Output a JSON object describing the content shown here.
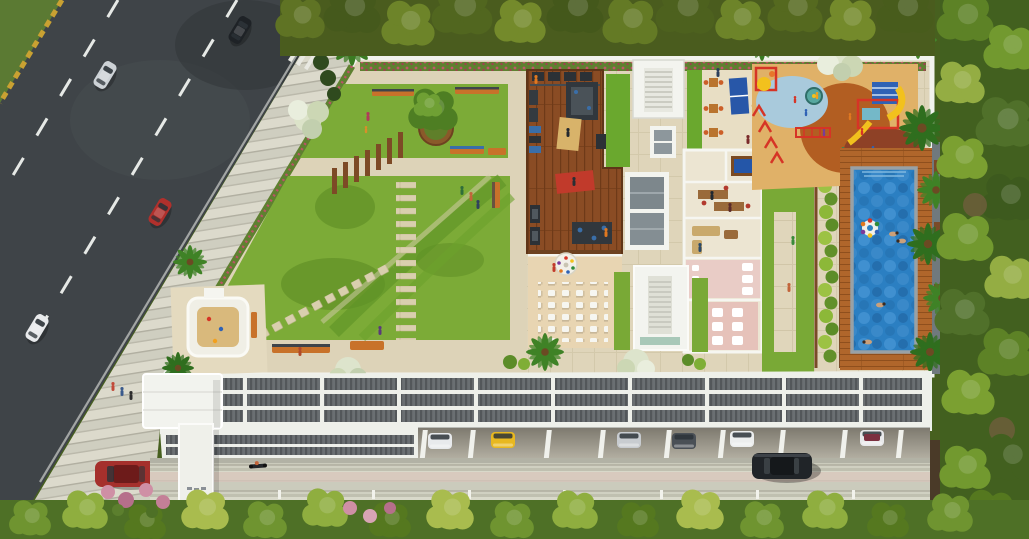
{
  "scene": {
    "title": "Aerial 3D architectural render of a residential podium amenity deck",
    "description": "Top-down rendering: city road with traffic on the left, landscaped rooftop podium with lawn garden, pergola, outdoor gym deck, stair cores with skylights, clubhouse rooms, party patio, kids play area and swimming pool; louvered parking canopy and driveway along the bottom; dense trees framing top, right and bottom edges.",
    "palette": {
      "asphalt": "#3f4448",
      "roadMarking": "#e6e9e6",
      "medianGrass": "#5b7a33",
      "curbYellow": "#c9a132",
      "sidewalk": "#cfcec0",
      "podiumPath": "#ddd3b8",
      "lawn": "#7cab37",
      "lawnShade": "#55851f",
      "deckWood": "#8a4c24",
      "poolDeckWood": "#b0662b",
      "poolWater": "#2b7fc2",
      "poolRim": "#99a1a5",
      "playFloor": "#e0b168",
      "playCircle": "#b25e22",
      "playBlue": "#a9cadc",
      "playRust": "#8e4126",
      "canopyWhite": "#eef0ea",
      "louverGray": "#6a6f72",
      "driveway": "#d0d0c1",
      "hedgeBright": "#8cb838",
      "hedgeDark": "#4e7026",
      "treesTop": "#4a5c1e",
      "treesRight": "#42601f",
      "benchOrange": "#c8722a",
      "accentRed": "#d63426",
      "accentYellow": "#f2c11d",
      "accentBlue": "#2f62b5",
      "flowerPink": "#c2566a",
      "wallWhite": "#f2f3ee"
    },
    "areas": [
      {
        "id": "street",
        "label": "Two-lane city road with moving cars and grass median"
      },
      {
        "id": "sidewalk",
        "label": "Striped paved sidewalk and entry plaza with pedestrians"
      },
      {
        "id": "garden",
        "label": "Podium lawn garden with curved mowing patterns, stepping-stone paths, pergola trellis row, central tree planter, benches and sand pit"
      },
      {
        "id": "gym-deck",
        "label": "Outdoor gym on dark timber deck with exercise machines and mats"
      },
      {
        "id": "cores",
        "label": "White stair cores and glazed skylight boxes flanked by grass strips"
      },
      {
        "id": "terrace",
        "label": "Seating terrace with orange dining sets, loungers and two table-tennis tables"
      },
      {
        "id": "clubhouse",
        "label": "Cutaway clubhouse rooms: billiards room, offices, lounge and washrooms"
      },
      {
        "id": "party-patio",
        "label": "Party patio with round buffet table and grid of white chairs"
      },
      {
        "id": "play-area",
        "label": "Children's play area with rubber flooring, slides, climbing cube and swings"
      },
      {
        "id": "pool",
        "label": "Rectangular lap pool with swimmers, float ring and timber sun deck"
      },
      {
        "id": "canopy",
        "label": "White louvered parking canopy over ground-level parking"
      },
      {
        "id": "parking",
        "label": "Open parking row with six visible parked cars between pillars"
      },
      {
        "id": "driveway",
        "label": "Concrete driveway with moving black sedan, scooter and bollard lights"
      },
      {
        "id": "vegetation",
        "label": "Dense trees and flowering shrubs framing the site"
      }
    ],
    "vehicles": {
      "on_road": [
        "silver sedan",
        "black sedan",
        "red sedan",
        "white sedan"
      ],
      "parked_street": [
        "red coupe"
      ],
      "parked_garage": [
        "white car",
        "yellow car",
        "silver car",
        "graphite car",
        "white car",
        "white car with maroon roof"
      ],
      "moving_driveway": [
        "black sedan",
        "scooter"
      ]
    },
    "amenities": [
      "lawn garden",
      "pergola",
      "tree planter",
      "sand pit",
      "outdoor gym",
      "table tennis",
      "billiards",
      "party patio",
      "kids play structures",
      "swimming pool",
      "sun deck",
      "benches"
    ]
  }
}
